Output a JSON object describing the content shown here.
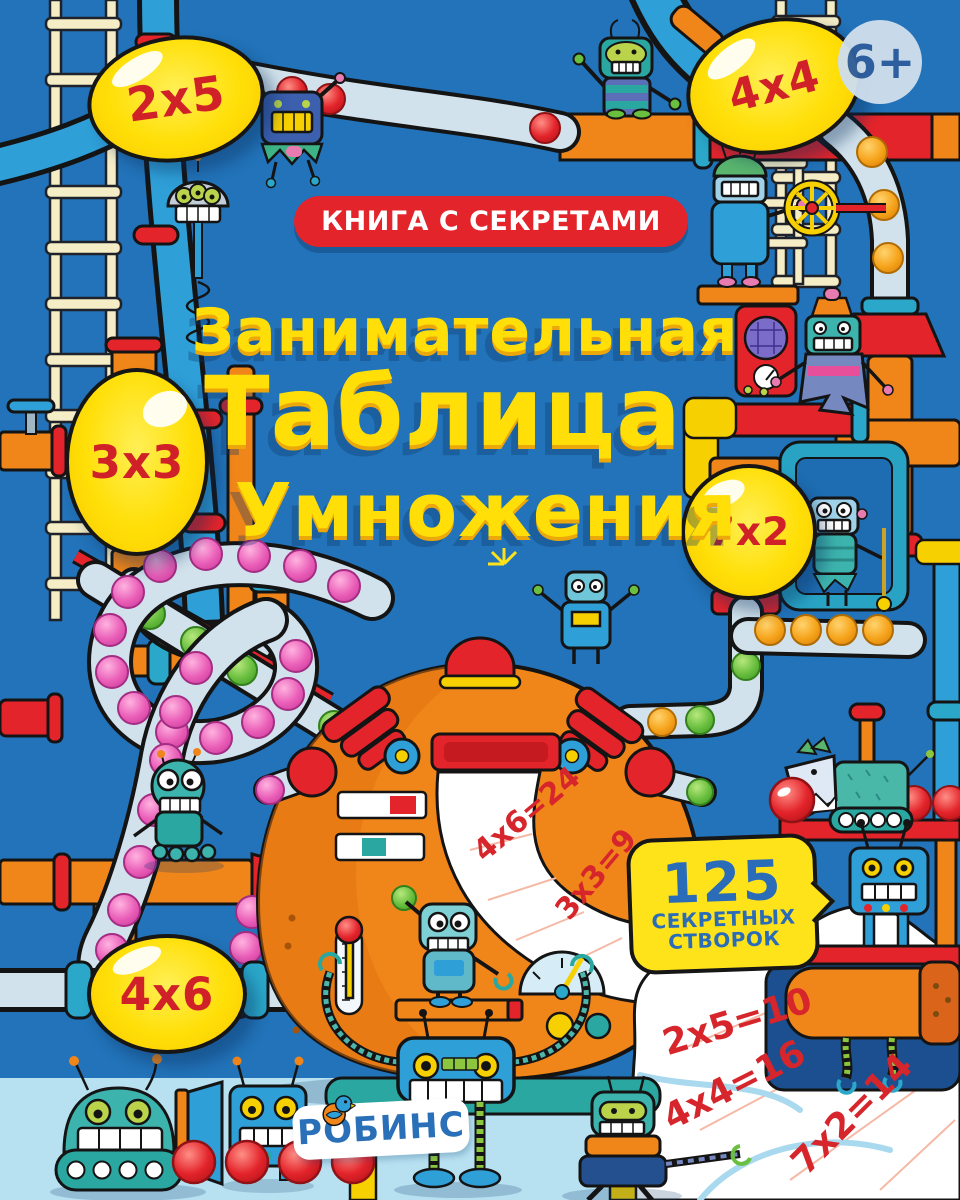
{
  "cover": {
    "age_badge": "6+",
    "banner": "КНИГА С СЕКРЕТАМИ",
    "title": {
      "line1": "Занимательная",
      "line2": "Таблица",
      "line3": "Умножения"
    },
    "bubbles": {
      "b2x5": "2х5",
      "b4x4": "4х4",
      "b3x3": "3х3",
      "b7x2": "7х2",
      "b4x6": "4х6"
    },
    "flaps_bubble": {
      "count": "125",
      "line1": "СЕКРЕТНЫХ",
      "line2": "СТВОРОК"
    },
    "machine_paper_equations": [
      "4х6=24",
      "3х3=9"
    ],
    "corner_paper_equations": [
      "2х5=10",
      "4х4=16",
      "7х2=14"
    ],
    "publisher": "РОБИНС",
    "colors": {
      "background": "#2273b9",
      "floor": "#b7e1f1",
      "bubble_yellow": "#ffe31a",
      "title_yellow": "#ffdf07",
      "accent_red": "#e3242b",
      "pipe_orange": "#f08519",
      "pipe_blue": "#2f9fd8",
      "text_blue": "#2b6cb8",
      "equation_red": "#d6262c"
    }
  }
}
